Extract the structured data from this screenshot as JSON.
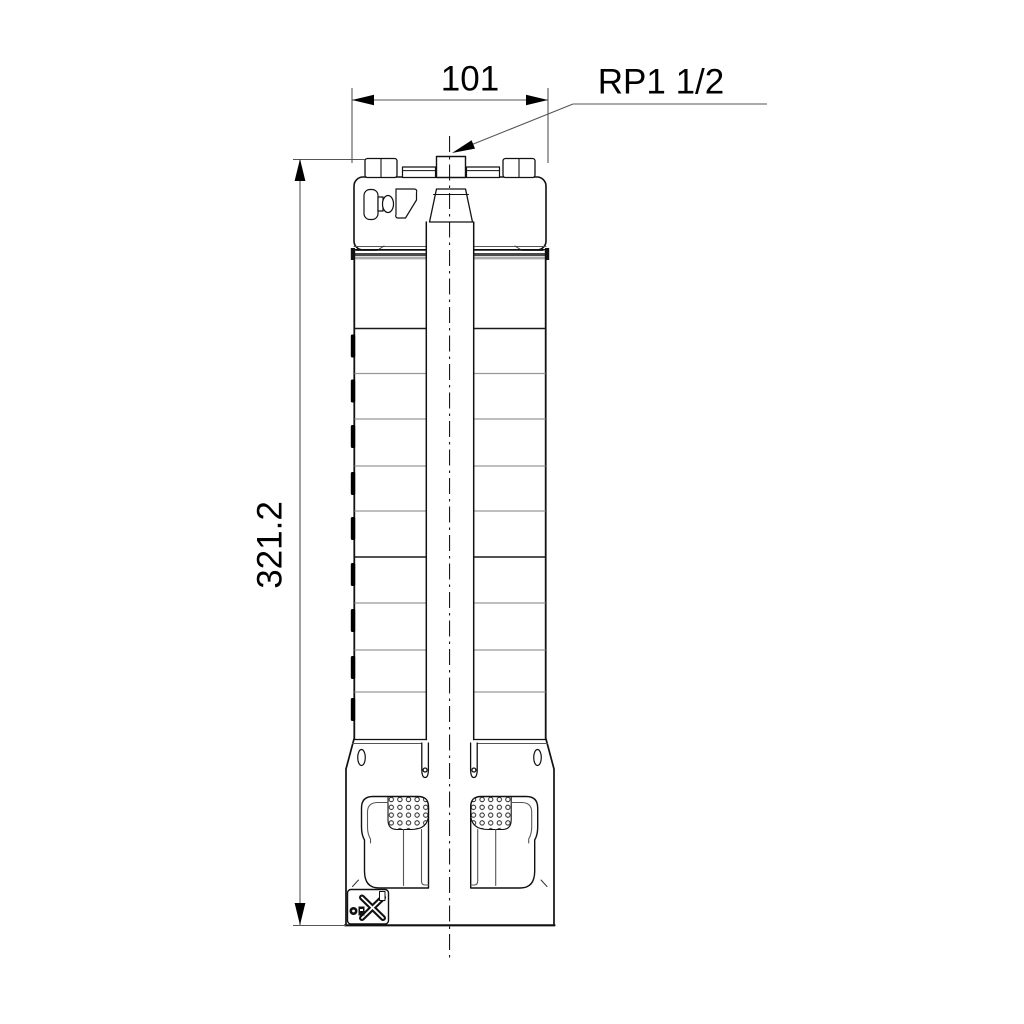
{
  "page": {
    "background": "#ffffff"
  },
  "drawing": {
    "kind": "technical dimensional drawing of a submersible borehole pump, front view",
    "colors": {
      "outline": "#111111",
      "dimension_lines": "#555555",
      "section_line_gray": "#999999",
      "background": "#ffffff"
    },
    "labels": {
      "width_dimension": "101",
      "height_dimension": "321.2",
      "connection": "RP1 1/2"
    },
    "icons": {
      "badge_logo": "manufacturer-x-logo",
      "arrowheads": "filled-triangle-arrow"
    }
  }
}
